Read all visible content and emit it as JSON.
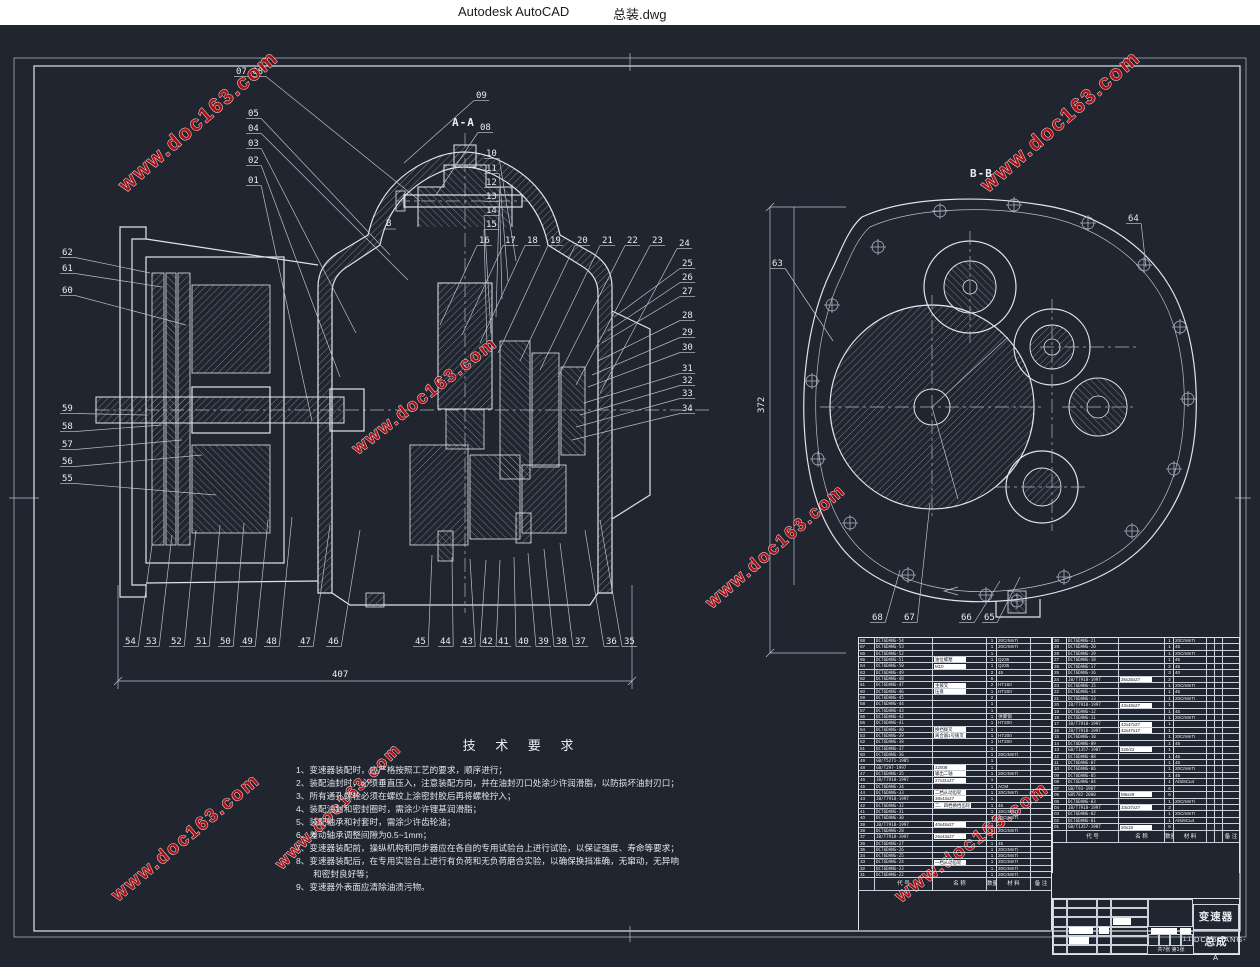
{
  "window": {
    "app_title": "Autodesk AutoCAD",
    "doc_title": "总装.dwg"
  },
  "colors": {
    "canvas_bg": "#20252f",
    "line": "#dfe5ec",
    "watermark_red": "#ad1116",
    "titlebar_bg": "#ffffff",
    "highlight_box": "#ffffff"
  },
  "watermark": {
    "text": "www.doc163.com",
    "instances": [
      {
        "x": 126,
        "y": 168,
        "r": -41,
        "s": 21
      },
      {
        "x": 988,
        "y": 168,
        "r": -41,
        "s": 21
      },
      {
        "x": 358,
        "y": 430,
        "r": -38,
        "s": 18
      },
      {
        "x": 712,
        "y": 584,
        "r": -41,
        "s": 18
      },
      {
        "x": 118,
        "y": 877,
        "r": -40,
        "s": 19
      },
      {
        "x": 282,
        "y": 845,
        "r": -45,
        "s": 17
      },
      {
        "x": 901,
        "y": 878,
        "r": -37,
        "s": 19
      },
      {
        "x": -150,
        "y": 105,
        "r": -41,
        "s": 21
      }
    ]
  },
  "markers": {
    "section_a": "A-A",
    "section_b": "B-B",
    "b_arrow": "B"
  },
  "dims": {
    "width_left_view": "407",
    "height_right_view": "372"
  },
  "callouts": {
    "left": [
      {
        "t": "07 08",
        "x": 236,
        "y": 49,
        "tx": 420,
        "ty": 176
      },
      {
        "t": "05",
        "x": 248,
        "y": 91,
        "tx": 390,
        "ty": 230
      },
      {
        "t": "04",
        "x": 248,
        "y": 106,
        "tx": 408,
        "ty": 255
      },
      {
        "t": "03",
        "x": 248,
        "y": 121,
        "tx": 356,
        "ty": 308
      },
      {
        "t": "02",
        "x": 248,
        "y": 138,
        "tx": 340,
        "ty": 352
      },
      {
        "t": "01",
        "x": 248,
        "y": 158,
        "tx": 312,
        "ty": 396
      },
      {
        "t": "09",
        "x": 476,
        "y": 73,
        "tx": 404,
        "ty": 138
      },
      {
        "t": "08",
        "x": 480,
        "y": 105,
        "tx": 436,
        "ty": 170
      },
      {
        "t": "10",
        "x": 486,
        "y": 131,
        "tx": 516,
        "ty": 236
      },
      {
        "t": "11",
        "x": 486,
        "y": 146,
        "tx": 508,
        "ty": 256
      },
      {
        "t": "12",
        "x": 486,
        "y": 160,
        "tx": 502,
        "ty": 274
      },
      {
        "t": "13",
        "x": 486,
        "y": 174,
        "tx": 496,
        "ty": 292
      },
      {
        "t": "14",
        "x": 486,
        "y": 188,
        "tx": 491,
        "ty": 308
      },
      {
        "t": "15",
        "x": 486,
        "y": 202,
        "tx": 487,
        "ty": 322
      },
      {
        "t": "16",
        "x": 479,
        "y": 218,
        "tx": 440,
        "ty": 300
      },
      {
        "t": "17",
        "x": 505,
        "y": 218,
        "tx": 462,
        "ty": 310
      },
      {
        "t": "18",
        "x": 527,
        "y": 218,
        "tx": 480,
        "ty": 318
      },
      {
        "t": "19",
        "x": 550,
        "y": 218,
        "tx": 498,
        "ty": 328
      },
      {
        "t": "20",
        "x": 577,
        "y": 218,
        "tx": 520,
        "ty": 336
      },
      {
        "t": "21",
        "x": 602,
        "y": 218,
        "tx": 540,
        "ty": 345
      },
      {
        "t": "22",
        "x": 627,
        "y": 218,
        "tx": 558,
        "ty": 352
      },
      {
        "t": "23",
        "x": 652,
        "y": 218,
        "tx": 576,
        "ty": 360
      },
      {
        "t": "24",
        "x": 679,
        "y": 221,
        "tx": 600,
        "ty": 368
      },
      {
        "t": "25",
        "x": 682,
        "y": 241,
        "tx": 614,
        "ty": 292
      },
      {
        "t": "26",
        "x": 682,
        "y": 255,
        "tx": 608,
        "ty": 306
      },
      {
        "t": "27",
        "x": 682,
        "y": 269,
        "tx": 602,
        "ty": 318
      },
      {
        "t": "28",
        "x": 682,
        "y": 293,
        "tx": 598,
        "ty": 336
      },
      {
        "t": "29",
        "x": 682,
        "y": 310,
        "tx": 592,
        "ty": 350
      },
      {
        "t": "30",
        "x": 682,
        "y": 325,
        "tx": 588,
        "ty": 362
      },
      {
        "t": "31",
        "x": 682,
        "y": 346,
        "tx": 584,
        "ty": 378
      },
      {
        "t": "32",
        "x": 682,
        "y": 358,
        "tx": 580,
        "ty": 390
      },
      {
        "t": "33",
        "x": 682,
        "y": 371,
        "tx": 576,
        "ty": 402
      },
      {
        "t": "34",
        "x": 682,
        "y": 386,
        "tx": 572,
        "ty": 415
      },
      {
        "t": "62",
        "x": 62,
        "y": 230,
        "tx": 150,
        "ty": 248
      },
      {
        "t": "61",
        "x": 62,
        "y": 246,
        "tx": 162,
        "ty": 262
      },
      {
        "t": "60",
        "x": 62,
        "y": 268,
        "tx": 186,
        "ty": 300
      },
      {
        "t": "59",
        "x": 62,
        "y": 386,
        "tx": 146,
        "ty": 390
      },
      {
        "t": "58",
        "x": 62,
        "y": 404,
        "tx": 162,
        "ty": 400
      },
      {
        "t": "57",
        "x": 62,
        "y": 422,
        "tx": 182,
        "ty": 415
      },
      {
        "t": "56",
        "x": 62,
        "y": 439,
        "tx": 202,
        "ty": 430
      },
      {
        "t": "55",
        "x": 62,
        "y": 456,
        "tx": 216,
        "ty": 470
      },
      {
        "t": "54",
        "x": 125,
        "y": 619,
        "tx": 152,
        "ty": 520
      },
      {
        "t": "53",
        "x": 146,
        "y": 619,
        "tx": 172,
        "ty": 510
      },
      {
        "t": "52",
        "x": 171,
        "y": 619,
        "tx": 196,
        "ty": 505
      },
      {
        "t": "51",
        "x": 196,
        "y": 619,
        "tx": 220,
        "ty": 500
      },
      {
        "t": "50",
        "x": 220,
        "y": 619,
        "tx": 244,
        "ty": 498
      },
      {
        "t": "49",
        "x": 242,
        "y": 619,
        "tx": 268,
        "ty": 495
      },
      {
        "t": "48",
        "x": 266,
        "y": 619,
        "tx": 292,
        "ty": 492
      },
      {
        "t": "47",
        "x": 300,
        "y": 619,
        "tx": 330,
        "ty": 500
      },
      {
        "t": "46",
        "x": 328,
        "y": 619,
        "tx": 360,
        "ty": 505
      },
      {
        "t": "45",
        "x": 415,
        "y": 619,
        "tx": 432,
        "ty": 530
      },
      {
        "t": "44",
        "x": 440,
        "y": 619,
        "tx": 452,
        "ty": 532
      },
      {
        "t": "43",
        "x": 462,
        "y": 619,
        "tx": 470,
        "ty": 534
      },
      {
        "t": "42",
        "x": 482,
        "y": 619,
        "tx": 486,
        "ty": 535
      },
      {
        "t": "41",
        "x": 498,
        "y": 619,
        "tx": 500,
        "ty": 535
      },
      {
        "t": "40",
        "x": 518,
        "y": 619,
        "tx": 514,
        "ty": 532
      },
      {
        "t": "39",
        "x": 538,
        "y": 619,
        "tx": 528,
        "ty": 528
      },
      {
        "t": "38",
        "x": 556,
        "y": 619,
        "tx": 544,
        "ty": 524
      },
      {
        "t": "37",
        "x": 575,
        "y": 619,
        "tx": 560,
        "ty": 518
      },
      {
        "t": "36",
        "x": 606,
        "y": 619,
        "tx": 585,
        "ty": 505
      },
      {
        "t": "35",
        "x": 624,
        "y": 619,
        "tx": 600,
        "ty": 495
      }
    ],
    "right": [
      {
        "t": "63",
        "x": 772,
        "y": 241,
        "tx": 833,
        "ty": 316
      },
      {
        "t": "64",
        "x": 1128,
        "y": 196,
        "tx": 1146,
        "ty": 242
      },
      {
        "t": "68",
        "x": 872,
        "y": 595,
        "tx": 900,
        "ty": 545
      },
      {
        "t": "67",
        "x": 904,
        "y": 595,
        "tx": 930,
        "ty": 478
      },
      {
        "t": "66",
        "x": 961,
        "y": 595,
        "tx": 1000,
        "ty": 556
      },
      {
        "t": "65",
        "x": 984,
        "y": 595,
        "tx": 1020,
        "ty": 552
      }
    ]
  },
  "tech_requirements": {
    "title": "技 术 要 求",
    "lines": [
      "1、变速器装配时，应严格按照工艺的要求，顺序进行；",
      "2、装配油封时，必须垂直压入，注意装配方向，并在油封刃口处涂少许润滑脂，以防损坏油封刃口；",
      "3、所有通孔螺栓必须在螺纹上涂密封胶后再将螺栓拧入；",
      "4、装配油封和密封圈时，需涂少许锂基润滑脂；",
      "5、装配轴承和衬套时，需涂少许齿轮油；",
      "6、差动轴承调整间隙为0.5~1mm；",
      "7、变速器装配前，操纵机构和同步器应在各自的专用试验台上进行试验，以保证强度、寿命等要求；",
      "8、变速器装配后，在专用实验台上进行有负荷和无负荷磨合实验，以确保换挡准确，无窜动，无异响",
      "　　和密封良好等；",
      "9、变速器外表面应清除油渍污物。"
    ]
  },
  "bom": {
    "headers": {
      "code": "代 号",
      "name": "名 称",
      "qty": "数量",
      "material": "材 料",
      "remark": "备 注"
    },
    "left_rows": [
      [
        "68",
        "DCT6DANG-54",
        "",
        "1",
        "20CrMnTi"
      ],
      [
        "67",
        "DCT6DANG-53",
        "",
        "1",
        "20CrMnTi"
      ],
      [
        "66",
        "DCT6DANG-52",
        "",
        "1",
        ""
      ],
      [
        "65",
        "DCT6DANG-51",
        "油位螺塞",
        "1",
        "Q235"
      ],
      [
        "64",
        "DCT6DANG-50",
        "M10",
        "1",
        "Q235"
      ],
      [
        "63",
        "DCT6DANG-49",
        "",
        "2",
        "45"
      ],
      [
        "62",
        "DCT6DANG-48",
        "",
        "6",
        ""
      ],
      [
        "61",
        "DCT6DANG-47",
        "主拨叉",
        "2",
        "HT150"
      ],
      [
        "60",
        "DCT6DANG-46",
        "压盘",
        "1",
        "HT200"
      ],
      [
        "59",
        "DCT6DANG-45",
        "",
        "2",
        ""
      ],
      [
        "58",
        "DCT6DANG-44",
        "",
        "1",
        ""
      ],
      [
        "57",
        "DCT6DANG-43",
        "",
        "1",
        ""
      ],
      [
        "56",
        "DCT6DANG-42",
        "",
        "1",
        "弹簧钢"
      ],
      [
        "55",
        "DCT6DANG-41",
        "",
        "1",
        "HT200"
      ],
      [
        "54",
        "DCT6DANG-40",
        "换挡拨叉",
        "1",
        ""
      ],
      [
        "53",
        "DCT6DANG-39",
        "离合器1号拨叉",
        "1",
        "HT200"
      ],
      [
        "52",
        "DCT6DANG-38",
        "",
        "1",
        "HT200"
      ],
      [
        "51",
        "DCT6DANG-37",
        "",
        "1",
        ""
      ],
      [
        "50",
        "DCT6DANG-36",
        "",
        "1",
        "20CrMnTi"
      ],
      [
        "49",
        "GB/T5271-1985",
        "",
        "1",
        ""
      ],
      [
        "48",
        "GB/T297-1997",
        "32008",
        "1",
        ""
      ],
      [
        "47",
        "DCT6DANG-35",
        "输出二轴",
        "1",
        "20CrMnTi"
      ],
      [
        "46",
        "JB/T7918-1997",
        "27x31x27",
        "1",
        ""
      ],
      [
        "45",
        "DCT6DANG-34",
        "",
        "1",
        "ACM"
      ],
      [
        "44",
        "DCT6DANG-33",
        "二档从动齿轮",
        "1",
        "20CrMnTi"
      ],
      [
        "43",
        "JB/T7918-1997",
        "38x43x27",
        "1",
        ""
      ],
      [
        "42",
        "DCT6DANG-32",
        "二、四档换挡齿轮",
        "1",
        "45"
      ],
      [
        "41",
        "DCT6DANG-31",
        "",
        "1",
        "20CrMnTi"
      ],
      [
        "40",
        "DCT6DANG-30",
        "",
        "1",
        "20CrMnTi"
      ],
      [
        "39",
        "JB/T7918-1997",
        "40x45x27",
        "1",
        ""
      ],
      [
        "38",
        "DCT6DANG-28",
        "",
        "1",
        "20CrMnTi"
      ],
      [
        "37",
        "JB/T7918-1997",
        "25x43x27",
        "1",
        ""
      ],
      [
        "36",
        "DCT6DANG-27",
        "",
        "1",
        "45"
      ],
      [
        "35",
        "DCT6DANG-26",
        "",
        "1",
        "20CrMnTi"
      ],
      [
        "34",
        "DCT6DANG-25",
        "",
        "1",
        "20CrMnTi"
      ],
      [
        "33",
        "DCT6DANG-24",
        "一档从动齿轮",
        "1",
        "20CrMnTi"
      ],
      [
        "32",
        "DCT6DANG-23",
        "",
        "1",
        "20CrMnTi"
      ],
      [
        "31",
        "DCT6DANG-22",
        "",
        "1",
        "20CrMnTi"
      ]
    ],
    "right_rows": [
      [
        "30",
        "DCT6DANG-21",
        "",
        "1",
        "20CrMnTi"
      ],
      [
        "29",
        "DCT6DANG-20",
        "",
        "1",
        "45"
      ],
      [
        "28",
        "DCT6DANG-19",
        "",
        "1",
        "20CrMnTi"
      ],
      [
        "27",
        "DCT6DANG-18",
        "",
        "1",
        "45"
      ],
      [
        "26",
        "DCT6DANG-17",
        "",
        "2",
        "45"
      ],
      [
        "25",
        "DCT6DANG-16",
        "",
        "3",
        "40"
      ],
      [
        "24",
        "JB/T7918-1997",
        "35x25x27",
        "2",
        ""
      ],
      [
        "23",
        "DCT6DANG-15",
        "",
        "1",
        "20CrMnTi"
      ],
      [
        "22",
        "DCT6DANG-14",
        "",
        "1",
        "45"
      ],
      [
        "21",
        "DCT6DANG-13",
        "",
        "1",
        "20CrMnTi"
      ],
      [
        "20",
        "JB/T7918-1997",
        "43x48x27",
        "1",
        ""
      ],
      [
        "19",
        "DCT6DANG-12",
        "",
        "1",
        "45"
      ],
      [
        "18",
        "DCT6DANG-11",
        "",
        "1",
        "20CrMnTi"
      ],
      [
        "17",
        "JB/T7918-1997",
        "42x47x27",
        "1",
        ""
      ],
      [
        "16",
        "JB/T7918-1997",
        "42x47x17",
        "1",
        ""
      ],
      [
        "15",
        "DCT6DANG-10",
        "",
        "1",
        "20CrMnTi"
      ],
      [
        "14",
        "DCT6DANG-09",
        "",
        "1",
        "45"
      ],
      [
        "13",
        "GB/T1357-1987",
        "320/22",
        "1",
        ""
      ],
      [
        "12",
        "DCT6DANG-08",
        "",
        "1",
        "45"
      ],
      [
        "11",
        "DCT6DANG-07",
        "",
        "1",
        "45"
      ],
      [
        "10",
        "DCT6DANG-06",
        "",
        "1",
        "20CrMnTi"
      ],
      [
        "09",
        "DCT6DANG-05",
        "",
        "1",
        "45"
      ],
      [
        "08",
        "DCT6DANG-04",
        "",
        "1",
        "AlSi9Cu4"
      ],
      [
        "07",
        "GB/T93-1987",
        "",
        "6",
        ""
      ],
      [
        "06",
        "GB5782-2000",
        "M6x28",
        "6",
        ""
      ],
      [
        "05",
        "DCT6DANG-03",
        "",
        "1",
        "20CrMnTi"
      ],
      [
        "04",
        "JB/T7918-1997",
        "33x37x27",
        "3",
        ""
      ],
      [
        "03",
        "DCT6DANG-02",
        "",
        "1",
        "20CrMnTi"
      ],
      [
        "02",
        "DCT6DANG-01",
        "",
        "1",
        "AlSi9Cu4"
      ],
      [
        "01",
        "GB/T1357-1987",
        "20x18",
        "6",
        ""
      ]
    ]
  },
  "title_block": {
    "title": "变速器总成",
    "drawing_no": "DCT6DANG-A",
    "scale": "1:1",
    "sheet": "共7张  第1张"
  }
}
